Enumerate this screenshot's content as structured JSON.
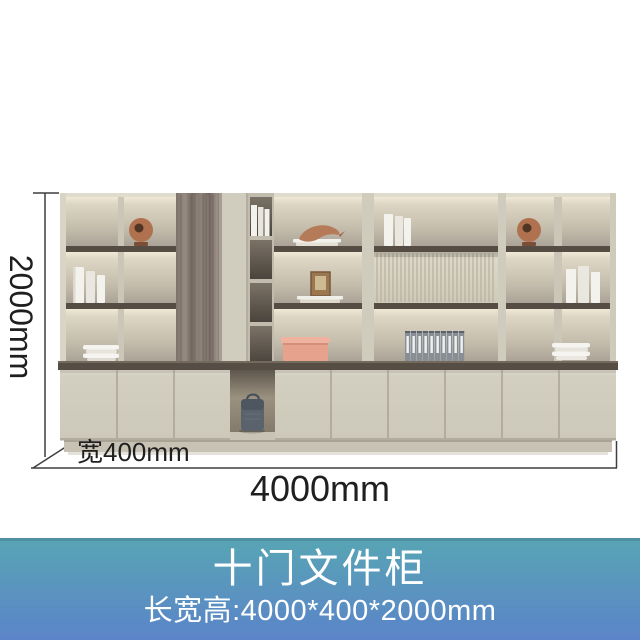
{
  "dimensions": {
    "height": "2000mm",
    "depth": "宽400mm",
    "width": "4000mm"
  },
  "banner": {
    "title": "十门文件柜",
    "subtitle": "长宽高:4000*400*2000mm",
    "text_color": "#ffffff",
    "gradient_top": "#58a4b5",
    "gradient_bottom": "#5b84c9",
    "top_border": "#4f8fa2"
  },
  "palette": {
    "dimension_text": "#1f1f1f",
    "dimension_line": "#3f3f3f",
    "cabinet_frame": "#cbc6b8",
    "shelf_board": "#554d43",
    "countertop": "#564e44",
    "wood_panel": "#8d8178",
    "fluted_panel": "#d9d3c3",
    "doors": "#d2cec0",
    "plinth": "#c7c2b4",
    "accent_box_pink": "#e7a28e",
    "accent_copper": "#b0714f",
    "binder_gray": "#878e96",
    "bag_gray": "#5a626c"
  }
}
